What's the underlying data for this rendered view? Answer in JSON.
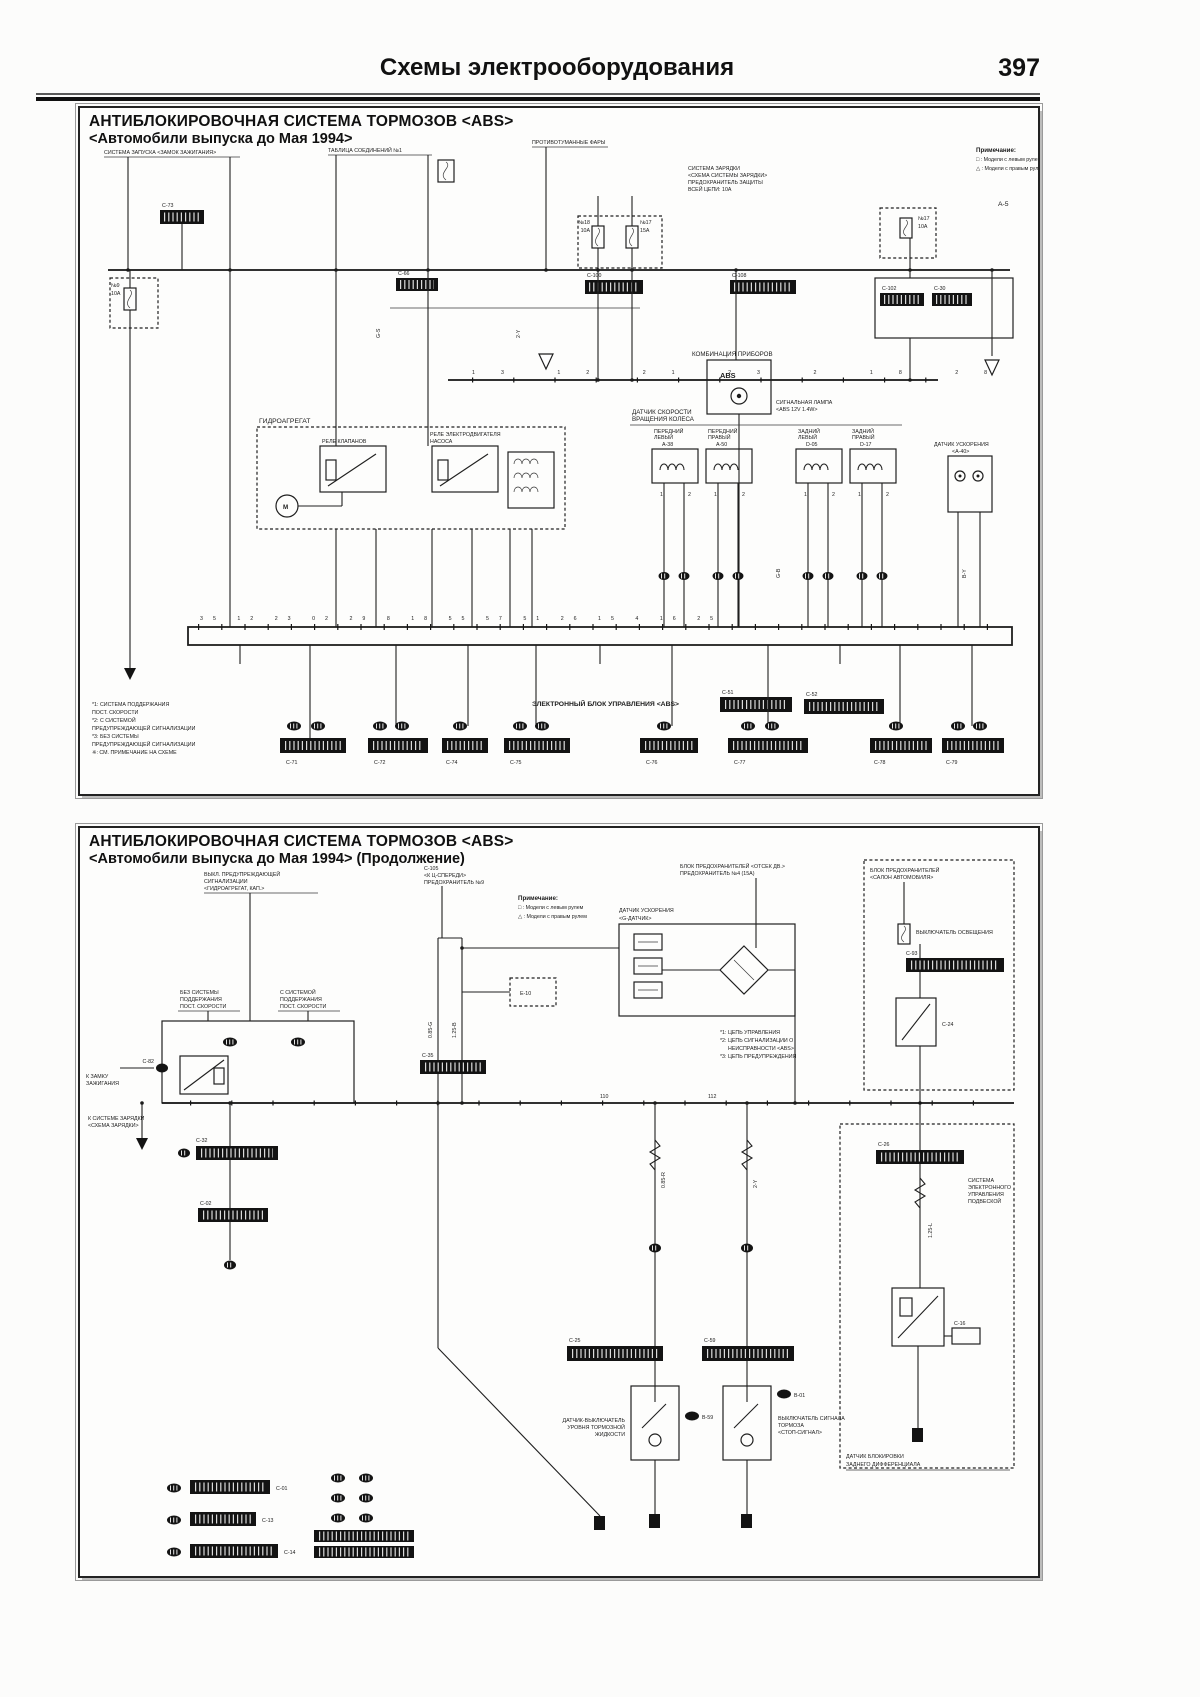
{
  "page": {
    "header_title": "Схемы электрооборудования",
    "page_number": "397"
  },
  "note": {
    "heading": "Примечание:",
    "lhd": "□ : Модели с левым рулем",
    "rhd": "△ : Модели с правым рулем"
  },
  "p1": {
    "title1": "АНТИБЛОКИРОВОЧНАЯ СИСТЕМА ТОРМОЗОВ <ABS>",
    "title2": "<Автомобили выпуска до Мая 1994>",
    "corner_ref": "А-5",
    "caps": {
      "ignition": "СИСТЕМА ЗАПУСКА <ЗАМОК ЗАЖИГАНИЯ>",
      "table": "ТАБЛИЦА СОЕДИНЕНИЙ №1",
      "fog": "ПРОТИВОТУМАННЫЕ ФАРЫ",
      "charge1": "СИСТЕМА ЗАРЯДКИ",
      "charge2": "<СХЕМА СИСТЕМЫ ЗАРЯДКИ>",
      "charge3": "ПРЕДОХРАНИТЕЛЬ ЗАЩИТЫ",
      "charge4": "ВСЕЙ ЦЕПИ: 10А",
      "cluster": "КОМБИНАЦИЯ ПРИБОРОВ",
      "cluster_lamp1": "СИГНАЛЬНАЯ ЛАМПА",
      "cluster_lamp2": "<ABS 12V 1.4W>",
      "hydro": "ГИДРОАГРЕГАТ",
      "relay1": "РЕЛЕ КЛАПАНОВ",
      "relay2a": "РЕЛЕ ЭЛЕКТРОДВИГАТЕЛЯ",
      "relay2b": "НАСОСА",
      "sensors1": "ДАТЧИК СКОРОСТИ",
      "sensors2": "ВРАЩЕНИЯ КОЛЕСА",
      "gsensor1": "ДАТЧИК УСКОРЕНИЯ",
      "gsensor2": "<A-40>",
      "ecu": "ЭЛЕКТРОННЫЙ БЛОК УПРАВЛЕНИЯ <ABS>"
    },
    "abs_lamp": "ABS",
    "motor": "M",
    "fuses": {
      "l_name": "№9",
      "l_amp": "10А",
      "f1_name": "№18",
      "f1_amp": "10А",
      "f2_name": "№17",
      "f2_amp": "15А",
      "f3_name": "№17",
      "f3_amp": "10А"
    },
    "conns": {
      "c73": "C-73",
      "c66": "C-66",
      "c100": "C-100",
      "c108": "C-108",
      "c102": "C-102",
      "c30": "C-30",
      "e51": "C-51",
      "e52": "C-52"
    },
    "sensors": [
      {
        "l1": "ПЕРЕДНИЙ",
        "l2": "ЛЕВЫЙ",
        "id": "A-38"
      },
      {
        "l1": "ПЕРЕДНИЙ",
        "l2": "ПРАВЫЙ",
        "id": "A-50"
      },
      {
        "l1": "ЗАДНИЙ",
        "l2": "ЛЕВЫЙ",
        "id": "D-05"
      },
      {
        "l1": "ЗАДНИЙ",
        "l2": "ПРАВЫЙ",
        "id": "D-17"
      }
    ],
    "pins_top": "13 12 21 23 2 18 28 3",
    "pins_ecu": "35 12 23 02 29 8 18 55 57 51 26 15 4 16 25",
    "pin1": "1",
    "pin2": "2",
    "bottom_conns": [
      "C-71",
      "C-72",
      "C-74",
      "C-75",
      "C-76",
      "C-77",
      "C-78",
      "C-79"
    ],
    "footnotes": [
      "*1: СИСТЕМА ПОДДЕРЖАНИЯ",
      "ПОСТ. СКОРОСТИ",
      "*2: С СИСТЕМОЙ",
      "ПРЕДУПРЕЖДАЮЩЕЙ СИГНАЛИЗАЦИИ",
      "*3: БЕЗ СИСТЕМЫ",
      "ПРЕДУПРЕЖДАЮЩЕЙ СИГНАЛИЗАЦИИ",
      "※: СМ. ПРИМЕЧАНИЕ НА СХЕМЕ"
    ],
    "wires": [
      "2-Y",
      "G-B",
      "B-Y",
      "G-S"
    ]
  },
  "p2": {
    "title1": "АНТИБЛОКИРОВОЧНАЯ СИСТЕМА ТОРМОЗОВ <ABS>",
    "title2": "<Автомобили выпуска до Мая 1994> (Продолжение)",
    "caps": {
      "c1a": "ВЫКЛ. ПРЕДУПРЕЖДАЮЩЕЙ",
      "c1b": "СИГНАЛИЗАЦИИ",
      "c1c": "<ГИДРОАГРЕГАТ, КАП.>",
      "c2a": "C-105",
      "c2b": "<К Ц-СПЕРЕДИ>",
      "c2c": "ПРЕДОХРАНИТЕЛЬ №9",
      "c3a": "БЛОК ПРЕДОХРАНИТЕЛЕЙ <ОТСЕК ДВ.>",
      "c3b": "ПРЕДОХРАНИТЕЛЬ №4 (15А)",
      "rb1": "БЛОК ПРЕДОХРАНИТЕЛЕЙ",
      "rb2": "<САЛОН АВТОМОБИЛЯ>",
      "rb3": "ВЫКЛЮЧАТЕЛЬ ОСВЕЩЕНИЯ",
      "no1": "БЕЗ СИСТЕМЫ",
      "no2": "ПОДДЕРЖАНИЯ",
      "no3": "ПОСТ. СКОРОСТИ",
      "yes1": "С СИСТЕМОЙ",
      "yes2": "ПОДДЕРЖАНИЯ",
      "yes3": "ПОСТ. СКОРОСТИ",
      "ign1": "К ЗАМКУ",
      "ign2": "ЗАЖИГАНИЯ",
      "charge1": "К СИСТЕМЕ ЗАРЯДКИ",
      "charge2": "<СХЕМА ЗАРЯДКИ>",
      "g1": "ДАТЧИК УСКОРЕНИЯ",
      "g2": "<G-ДАТЧИК>",
      "sw1a": "ДАТЧИК-ВЫКЛЮЧАТЕЛЬ",
      "sw1b": "УРОВНЯ ТОРМОЗНОЙ",
      "sw1c": "ЖИДКОСТИ",
      "sw2a": "ВЫКЛЮЧАТЕЛЬ СИГНАЛА",
      "sw2b": "ТОРМОЗА",
      "sw2c": "<СТОП-СИГНАЛ>",
      "rc1": "СИСТЕМА",
      "rc2": "ЭЛЕКТРОННОГО",
      "rc3": "УПРАВЛЕНИЯ",
      "rc4": "ПОДВЕСКОЙ",
      "bn1": "ДАТЧИК БЛОКИРОВКИ",
      "bn2": "ЗАДНЕГО ДИФФЕРЕНЦИАЛА"
    },
    "notes": [
      "*1: ЦЕПЬ УПРАВЛЕНИЯ",
      "*2: ЦЕПЬ СИГНАЛИЗАЦИИ О",
      "НЕИСПРАВНОСТИ <ABS>",
      "*3: ЦЕПЬ ПРЕДУПРЕЖДЕНИЯ"
    ],
    "conns": {
      "c82": "C-82",
      "c32": "C-32",
      "c02": "C-02",
      "c35": "C-35",
      "c93": "C-93",
      "c24": "C-24",
      "c25": "C-25",
      "c59": "C-59",
      "c26": "C-26",
      "c16": "C-16",
      "e10": "Е-10",
      "b59": "B-59",
      "b01": "B-01",
      "bl1": "C-01",
      "bl2": "C-13",
      "bl3": "C-14"
    },
    "busnums": {
      "n1": "110",
      "n2": "112"
    },
    "wires": [
      "0.85-G",
      "1.25-B",
      "0.85-R",
      "2-Y",
      "1.25-L"
    ]
  }
}
